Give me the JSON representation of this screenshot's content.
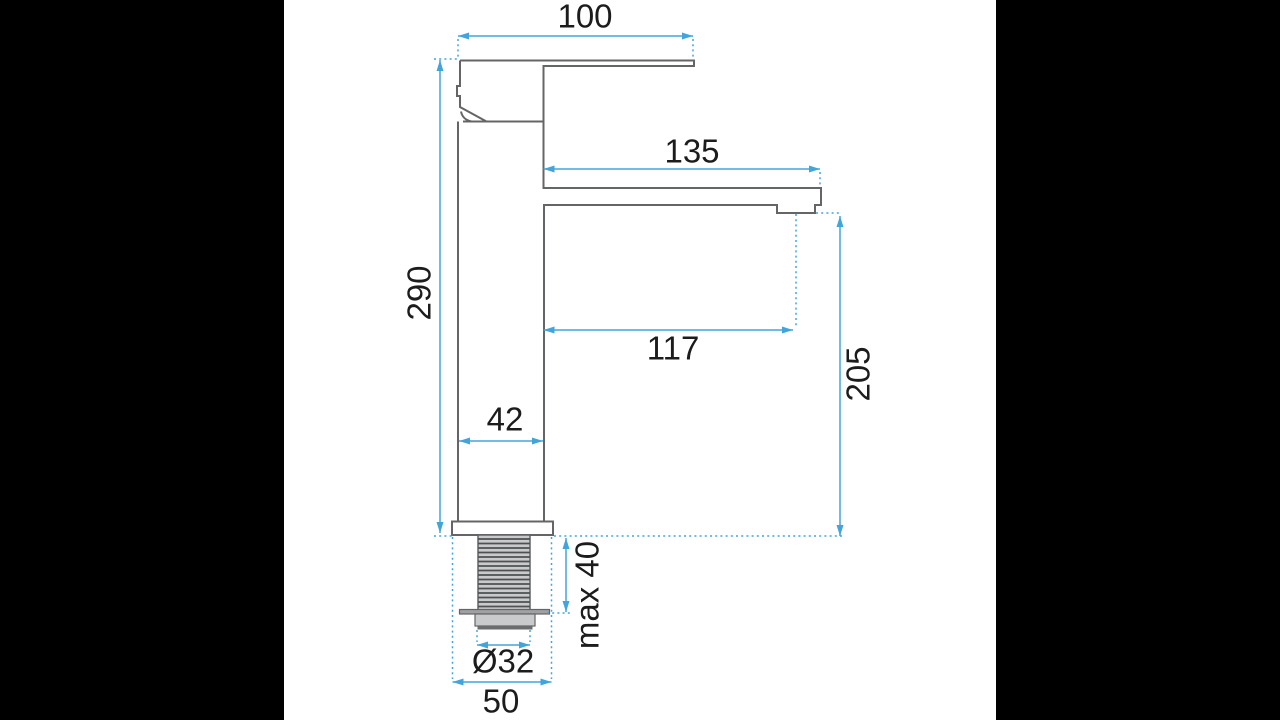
{
  "scene": {
    "type": "technical-dimension-drawing",
    "subject": "single-lever basin mixer tap, side view with installation dimensions",
    "units": "mm"
  },
  "colors": {
    "letterbox": "#000000",
    "canvas": "#ffffff",
    "accent": "#41a5dc",
    "outline": "#646567",
    "text": "#1c1c1c",
    "metal_light": "#c8cacc",
    "metal_mid": "#9fa1a3",
    "metal_dark": "#6a6c6e",
    "thread": "#4e5052"
  },
  "dimensions": {
    "handle_width": {
      "label": "100",
      "orientation": "horizontal"
    },
    "spout_top_reach": {
      "label": "135",
      "orientation": "horizontal"
    },
    "total_height": {
      "label": "290",
      "orientation": "vertical"
    },
    "spout_reach": {
      "label": "117",
      "orientation": "horizontal"
    },
    "spout_height": {
      "label": "205",
      "orientation": "vertical"
    },
    "body_width": {
      "label": "42",
      "orientation": "horizontal"
    },
    "max_deck_thickness": {
      "label": "max 40",
      "orientation": "vertical"
    },
    "hole_diameter": {
      "label": "Ø32",
      "orientation": "horizontal"
    },
    "base_width": {
      "label": "50",
      "orientation": "horizontal"
    }
  }
}
